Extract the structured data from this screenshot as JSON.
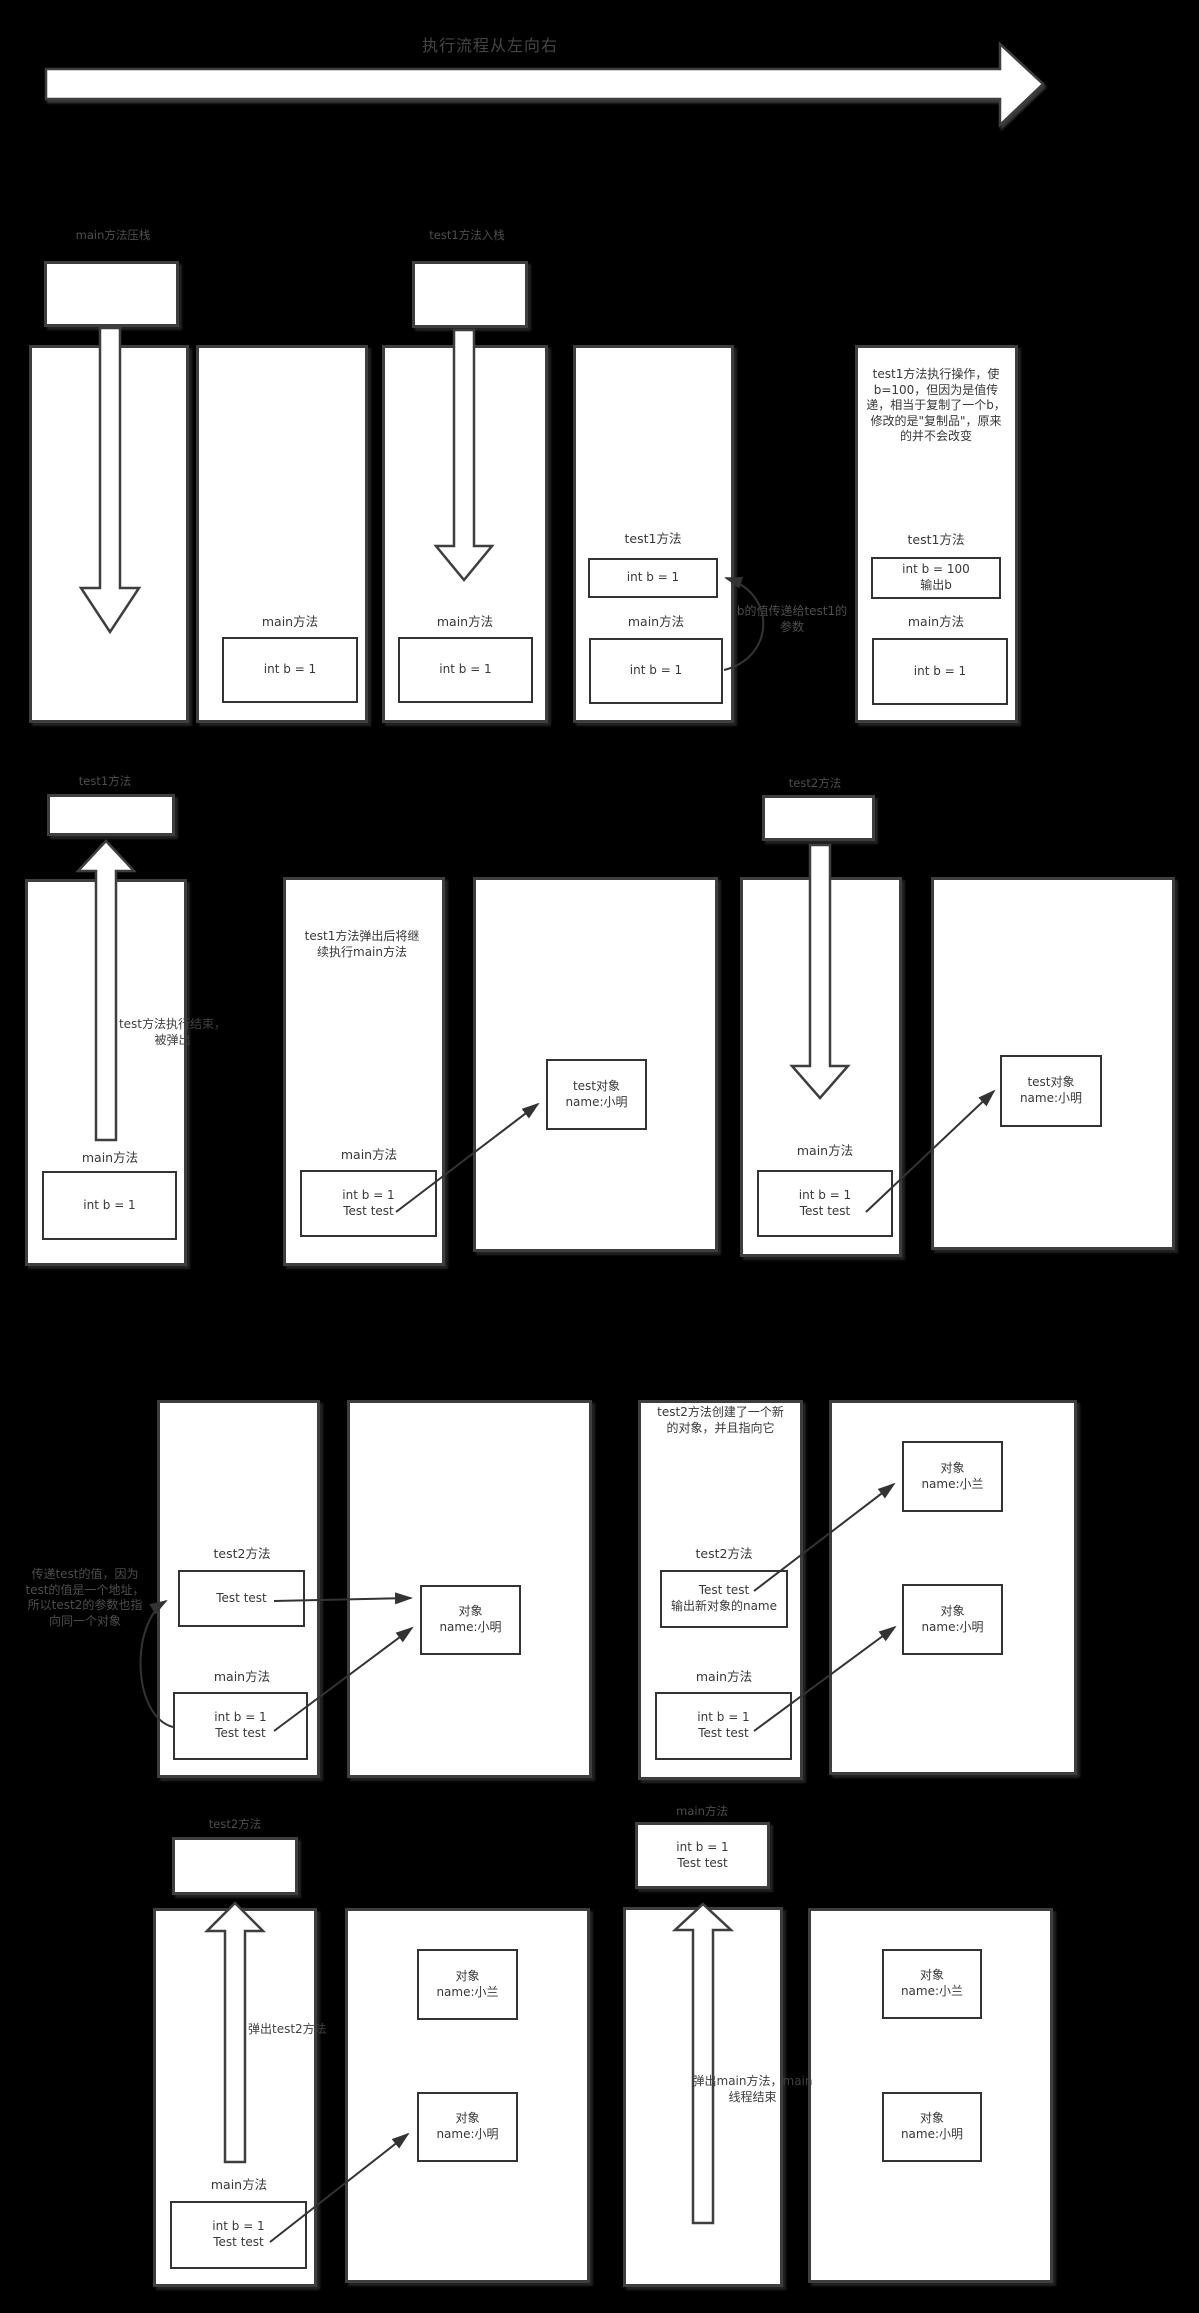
{
  "title": "执行流程从左向右",
  "colors": {
    "background": "#000000",
    "panel_fill": "#ffffff",
    "panel_border": "#3e3e3e",
    "box_border": "#333333",
    "text_on_white": "#383838",
    "text_on_black": "#4d4d4d",
    "arrow_fill": "#ffffff",
    "connector": "#333333"
  },
  "row1": {
    "push_main_label": "main方法压栈",
    "push_test1_label": "test1方法入栈",
    "p2": {
      "method": "main方法",
      "box": "int b = 1"
    },
    "p3": {
      "method": "main方法",
      "box": "int b = 1"
    },
    "p4": {
      "test1_method": "test1方法",
      "test1_box": "int b = 1",
      "main_method": "main方法",
      "main_box": "int b = 1",
      "note": "b的值传递给test1的参数"
    },
    "p5": {
      "note": "test1方法执行操作，使b=100，但因为是值传递，相当于复制了一个b，修改的是\"复制品\"，原来的并不会改变",
      "test1_method": "test1方法",
      "test1_box_line1": "int b = 100",
      "test1_box_line2": "输出b",
      "main_method": "main方法",
      "main_box": "int b = 1"
    }
  },
  "row2": {
    "test1_label": "test1方法",
    "test2_label": "test2方法",
    "p1": {
      "note": "test方法执行结束，被弹出",
      "main_method": "main方法",
      "main_box": "int b = 1"
    },
    "p2": {
      "note": "test1方法弹出后将继续执行main方法",
      "main_method": "main方法",
      "box_line1": "int b = 1",
      "box_line2": "Test test"
    },
    "p3": {
      "obj_line1": "test对象",
      "obj_line2": "name:小明"
    },
    "p4": {
      "main_method": "main方法",
      "box_line1": "int b = 1",
      "box_line2": "Test test"
    },
    "p5": {
      "obj_line1": "test对象",
      "obj_line2": "name:小明"
    }
  },
  "row3": {
    "left_note": "传递test的值，因为test的值是一个地址，所以test2的参数也指向同一个对象",
    "p1": {
      "test2_method": "test2方法",
      "test2_box": "Test test",
      "main_method": "main方法",
      "main_box_line1": "int b = 1",
      "main_box_line2": "Test test"
    },
    "p2": {
      "obj_line1": "对象",
      "obj_line2": "name:小明"
    },
    "p3": {
      "note": "test2方法创建了一个新的对象，并且指向它",
      "test2_method": "test2方法",
      "test2_box_line1": "Test test",
      "test2_box_line2": "输出新对象的name",
      "main_method": "main方法",
      "main_box_line1": "int b = 1",
      "main_box_line2": "Test test"
    },
    "p4": {
      "objA_line1": "对象",
      "objA_line2": "name:小兰",
      "objB_line1": "对象",
      "objB_line2": "name:小明"
    }
  },
  "row4": {
    "test2_label": "test2方法",
    "main_label": "main方法",
    "top_box_line1": "int b = 1",
    "top_box_line2": "Test test",
    "p1": {
      "note": "弹出test2方法",
      "main_method": "main方法",
      "box_line1": "int b = 1",
      "box_line2": "Test test"
    },
    "p2": {
      "objA_line1": "对象",
      "objA_line2": "name:小兰",
      "objB_line1": "对象",
      "objB_line2": "name:小明"
    },
    "p3": {
      "note": "弹出main方法，main线程结束"
    },
    "p4": {
      "objA_line1": "对象",
      "objA_line2": "name:小兰",
      "objB_line1": "对象",
      "objB_line2": "name:小明"
    }
  }
}
